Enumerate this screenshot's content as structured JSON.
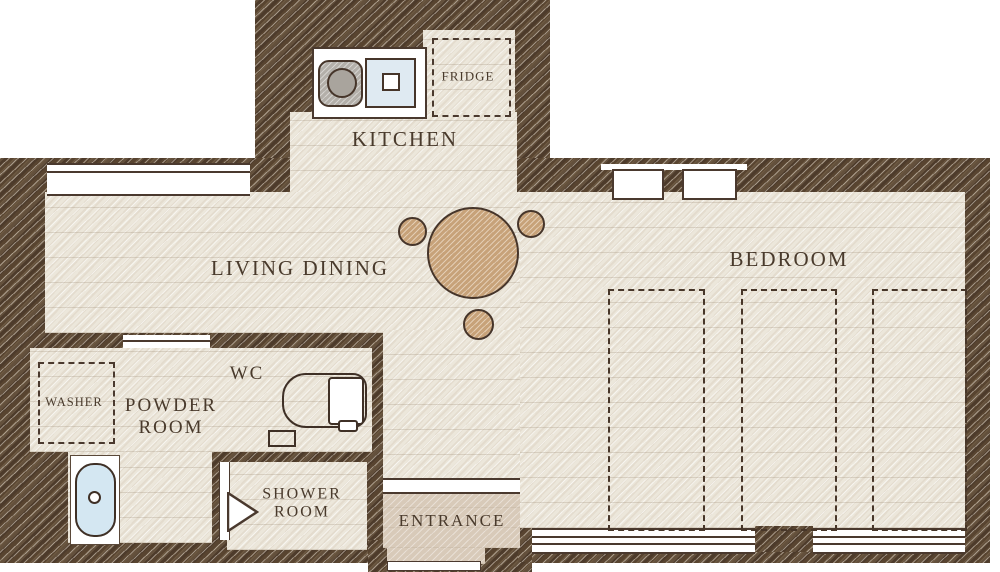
{
  "floor_plan": {
    "rooms": {
      "kitchen": {
        "label": "KITCHEN"
      },
      "fridge": {
        "label": "FRIDGE"
      },
      "living_dining": {
        "label": "LIVING DINING"
      },
      "bedroom": {
        "label": "BEDROOM"
      },
      "wc": {
        "label": "WC"
      },
      "powder_room": {
        "line1": "POWDER",
        "line2": "ROOM"
      },
      "washer": {
        "label": "WASHER"
      },
      "shower_room": {
        "line1": "SHOWER",
        "line2": "ROOM"
      },
      "entrance": {
        "label": "ENTRANCE"
      }
    },
    "colors": {
      "background": "#ffffff",
      "wall_brown": "#54412f",
      "floor_cream": "#ece7db",
      "entrance_floor_beige": "#d8cab9",
      "furniture_tan": "#c7a279",
      "water_blue": "#d4e7f2",
      "stove_gray": "#b3afa9",
      "outline_brown": "#4a392e",
      "label_brown": "#493a2c"
    }
  }
}
